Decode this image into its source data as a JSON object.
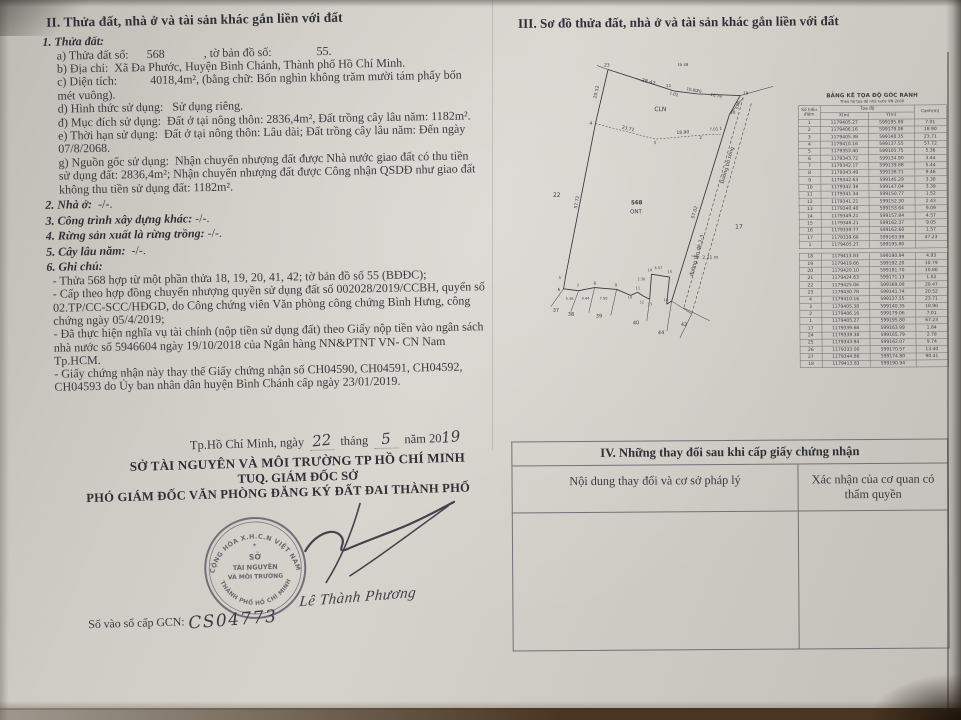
{
  "section_ii": {
    "heading": "II. Thửa đất, nhà ở và tài sản khác gắn liền với đất",
    "items": [
      {
        "style": "item-head",
        "bold": "1. Thửa đất:",
        "rest": ""
      },
      {
        "style": "line",
        "bold": "",
        "rest": "a) Thửa đất số:      568             , tờ bản đồ số:               55."
      },
      {
        "style": "line",
        "bold": "",
        "rest": "b) Địa chỉ:  Xã Đa Phước, Huyện Bình Chánh, Thành phố Hồ Chí Minh."
      },
      {
        "style": "line",
        "bold": "",
        "rest": "c) Diện tích:           4018,4m², (bằng chữ: Bốn nghìn không trăm mười tám phẩy bốn mét vuông)."
      },
      {
        "style": "line",
        "bold": "",
        "rest": "d) Hình thức sử dụng:   Sử dụng riêng."
      },
      {
        "style": "line",
        "bold": "",
        "rest": "đ) Mục đích sử dụng:  Đất ở tại nông thôn: 2836,4m², Đất trồng cây lâu năm: 1182m²."
      },
      {
        "style": "line",
        "bold": "",
        "rest": "e) Thời hạn sử dụng:  Đất ở tại nông thôn: Lâu dài; Đất trồng cây lâu năm: Đến ngày 07/8/2068."
      },
      {
        "style": "line",
        "bold": "",
        "rest": "g) Nguồn gốc sử dụng:  Nhận chuyển nhượng đất được Nhà nước giao đất có thu tiền sử dụng đất: 2836,4m²; Nhận chuyển nhượng đất được Công nhận QSDĐ như giao đất không thu tiền sử dụng đất: 1182m²."
      },
      {
        "style": "item-head",
        "bold": "2. Nhà ở:",
        "rest": "  -/-."
      },
      {
        "style": "item-head",
        "bold": "3. Công trình xây dựng khác:",
        "rest": " -/-."
      },
      {
        "style": "item-head",
        "bold": "4. Rừng sản xuất là rừng trồng:",
        "rest": " -/-."
      },
      {
        "style": "item-head",
        "bold": "5. Cây lâu năm:",
        "rest": "  -/-."
      },
      {
        "style": "item-head",
        "bold": "6. Ghi chú:",
        "rest": ""
      },
      {
        "style": "note",
        "bold": "",
        "rest": "- Thửa 568 hợp từ một phần thửa 18, 19, 20, 41, 42; tờ bản đồ số 55 (BĐĐC);"
      },
      {
        "style": "note",
        "bold": "",
        "rest": "- Cấp theo hợp đồng chuyển nhượng quyền sử dụng đất số 002028/2019/CCBH, quyển số 02.TP/CC-SCC/HĐGD, do Công chứng viên Văn phòng công chứng Bình Hưng, công chứng ngày 05/4/2019;"
      },
      {
        "style": "note",
        "bold": "",
        "rest": "- Đã thực hiện nghĩa vụ tài chính (nộp tiền sử dụng đất) theo Giấy nộp tiền vào ngân sách nhà nước số 5946604 ngày 19/10/2018 của Ngân hàng NN&PTNT VN- CN Nam Tp.HCM."
      },
      {
        "style": "note",
        "bold": "",
        "rest": "- Giấy chứng nhận này thay thế Giấy chứng nhận số CH04590, CH04591, CH04592, CH04593 do Ủy ban nhân dân huyện Bình Chánh cấp ngày 23/01/2019."
      }
    ]
  },
  "section_iii": {
    "heading": "III. Sơ đồ thửa đất, nhà ở và tài sản khác gắn liền với đất",
    "coord_table": {
      "title": "BẢNG KÊ TỌA ĐỘ GÓC RANH",
      "subtitle": "Theo hệ tọa độ nhà nước VN-2000",
      "col_point": "Số hiệu điểm",
      "col_coord": "Tọa độ",
      "col_x": "X(m)",
      "col_y": "Y(m)",
      "col_edge": "Cạnh(m)",
      "block1": [
        [
          "1",
          "1179405.27",
          "599195.80",
          "7.01"
        ],
        [
          "2",
          "1179406.16",
          "599179.06",
          "18.90"
        ],
        [
          "3",
          "1179405.38",
          "599140.35",
          "23.71"
        ],
        [
          "4",
          "1179410.16",
          "599137.55",
          "57.72"
        ],
        [
          "5",
          "1179353.40",
          "599105.75",
          "5.36"
        ],
        [
          "6",
          "1179343.72",
          "599134.90",
          "3.44"
        ],
        [
          "7",
          "1179342.17",
          "599139.88",
          "5.44"
        ],
        [
          "8",
          "1179343.49",
          "599138.71",
          "9.46"
        ],
        [
          "9",
          "1179342.63",
          "599145.29",
          "3.30"
        ],
        [
          "10",
          "1179342.38",
          "599147.04",
          "3.39"
        ],
        [
          "11",
          "1179341.34",
          "599150.77",
          "1.52"
        ],
        [
          "12",
          "1179341.21",
          "599152.30",
          "2.43"
        ],
        [
          "13",
          "1179340.40",
          "599153.64",
          "9.09"
        ],
        [
          "14",
          "1179349.21",
          "599157.84",
          "4.57"
        ],
        [
          "15",
          "1179348.21",
          "599162.37",
          "9.05"
        ],
        [
          "16",
          "1179339.77",
          "599162.60",
          "1.57"
        ],
        [
          "17",
          "1179339.68",
          "599163.99",
          "47.23"
        ],
        [
          "1",
          "1179405.27",
          "599195.80",
          ""
        ]
      ],
      "block2": [
        [
          "18",
          "1179413.83",
          "599190.94",
          "4.93"
        ],
        [
          "19",
          "1179419.66",
          "599192.20",
          "10.79"
        ],
        [
          "20",
          "1179420.10",
          "599181.70",
          "10.80"
        ],
        [
          "21",
          "1179424.63",
          "599171.13",
          "1.02"
        ],
        [
          "22",
          "1179425.06",
          "599169.08",
          "28.47"
        ],
        [
          "23",
          "1179430.78",
          "599141.74",
          "20.52"
        ],
        [
          "4",
          "1179410.16",
          "599137.55",
          "23.71"
        ],
        [
          "3",
          "1179405.38",
          "599140.35",
          "18.90"
        ],
        [
          "2",
          "1179406.16",
          "599179.06",
          "7.01"
        ],
        [
          "1",
          "1179405.27",
          "599195.80",
          "67.23"
        ],
        [
          "17",
          "1179339.68",
          "599163.99",
          "1.84"
        ],
        [
          "24",
          "1179339.38",
          "599165.79",
          "2.78"
        ],
        [
          "25",
          "1179343.94",
          "599162.07",
          "9.74"
        ],
        [
          "26",
          "1179333.00",
          "599170.57",
          "13.40"
        ],
        [
          "27",
          "1179344.86",
          "599174.80",
          "90.41"
        ],
        [
          "18",
          "1179413.83",
          "599190.94",
          ""
        ]
      ]
    },
    "diagram": {
      "labels": [
        {
          "id": "pt-23",
          "text": "23"
        },
        {
          "id": "meas-28-47",
          "text": "28.47"
        },
        {
          "id": "meas-1-02",
          "text": "1.02"
        },
        {
          "id": "pt-21",
          "text": "21"
        },
        {
          "id": "meas-10-80",
          "text": "10.80"
        },
        {
          "id": "pt-20",
          "text": "20"
        },
        {
          "id": "meas-10-79",
          "text": "10.79"
        },
        {
          "id": "pt-19",
          "text": "19"
        },
        {
          "id": "pt-18",
          "text": "18"
        },
        {
          "id": "meas-5-05",
          "text": "5.05"
        },
        {
          "id": "lbl-to48",
          "text": "tờ 48"
        },
        {
          "id": "meas-20-52",
          "text": "20.52"
        },
        {
          "id": "meas-57-72",
          "text": "57.72"
        },
        {
          "id": "pt-4",
          "text": "4"
        },
        {
          "id": "meas-23-71",
          "text": "23.71"
        },
        {
          "id": "pt-3",
          "text": "3"
        },
        {
          "id": "meas-18-90",
          "text": "18.90"
        },
        {
          "id": "pt-2",
          "text": "2"
        },
        {
          "id": "meas-7-01",
          "text": "7.01"
        },
        {
          "id": "pt-1",
          "text": "1"
        },
        {
          "id": "lbl-cln",
          "text": "CLN"
        },
        {
          "id": "lbl-568",
          "text": "568"
        },
        {
          "id": "lbl-ont",
          "text": "ONT"
        },
        {
          "id": "lbl-22",
          "text": "22"
        },
        {
          "id": "lbl-17",
          "text": "17"
        },
        {
          "id": "meas-57-02",
          "text": "57.02"
        },
        {
          "id": "road-upper",
          "text": "Đường bờ sông"
        },
        {
          "id": "road-lower",
          "text": "đường lấn đê 2-3"
        },
        {
          "id": "meas-2-11",
          "text": "2.11 m"
        },
        {
          "id": "pt-5",
          "text": "5"
        },
        {
          "id": "pt-6",
          "text": "6"
        },
        {
          "id": "pt-7",
          "text": "7"
        },
        {
          "id": "pt-8",
          "text": "8"
        },
        {
          "id": "pt-9",
          "text": "9"
        },
        {
          "id": "pt-10",
          "text": "10"
        },
        {
          "id": "pt-11",
          "text": "11"
        },
        {
          "id": "pt-12",
          "text": "12"
        },
        {
          "id": "pt-13",
          "text": "13"
        },
        {
          "id": "pt-14",
          "text": "14"
        },
        {
          "id": "pt-15",
          "text": "15"
        },
        {
          "id": "pt-16",
          "text": "16"
        },
        {
          "id": "meas-5-36",
          "text": "5.36"
        },
        {
          "id": "meas-5-44",
          "text": "5.44"
        },
        {
          "id": "meas-7-50",
          "text": "7.50"
        },
        {
          "id": "meas-2-30",
          "text": "2.30"
        },
        {
          "id": "meas-4-57",
          "text": "4.57"
        },
        {
          "id": "nb-37",
          "text": "37"
        },
        {
          "id": "nb-38",
          "text": "38"
        },
        {
          "id": "nb-39",
          "text": "39"
        },
        {
          "id": "nb-40",
          "text": "40"
        },
        {
          "id": "nb-44",
          "text": "44"
        },
        {
          "id": "nb-42",
          "text": "42"
        }
      ]
    }
  },
  "section_iv": {
    "title": "IV. Những thay đổi sau khi cấp giấy chứng nhận",
    "col1": "Nội dung thay đổi và cơ sở pháp lý",
    "col2": "Xác nhận của cơ quan có thẩm quyền"
  },
  "issuance": {
    "place_date_prefix": "Tp.Hồ Chí Minh, ngày",
    "day": "22",
    "month_label": "tháng",
    "month": "5",
    "year_label": "năm 20",
    "year": "19",
    "dept_line": "SỞ TÀI NGUYÊN VÀ MÔI TRƯỜNG TP HỒ CHÍ MINH",
    "tuq_line": "TUQ. GIÁM ĐỐC SỞ",
    "deputy_line": "PHÓ GIÁM ĐỐC VĂN PHÒNG ĐĂNG KÝ ĐẤT ĐAI THÀNH PHỐ",
    "signer_name": "Lê Thành Phương",
    "gcn_label": "Số vào sổ cấp GCN:",
    "gcn_number": "CS04773",
    "stamp": {
      "arc_top": "CỘNG HÒA X.H.C.N VIỆT NAM",
      "center1": "SỞ",
      "center2": "TÀI NGUYÊN",
      "center3": "VÀ MÔI TRƯỜNG",
      "arc_bottom": "THÀNH PHỐ HỒ CHÍ MINH",
      "ink_color": "#565864"
    }
  }
}
